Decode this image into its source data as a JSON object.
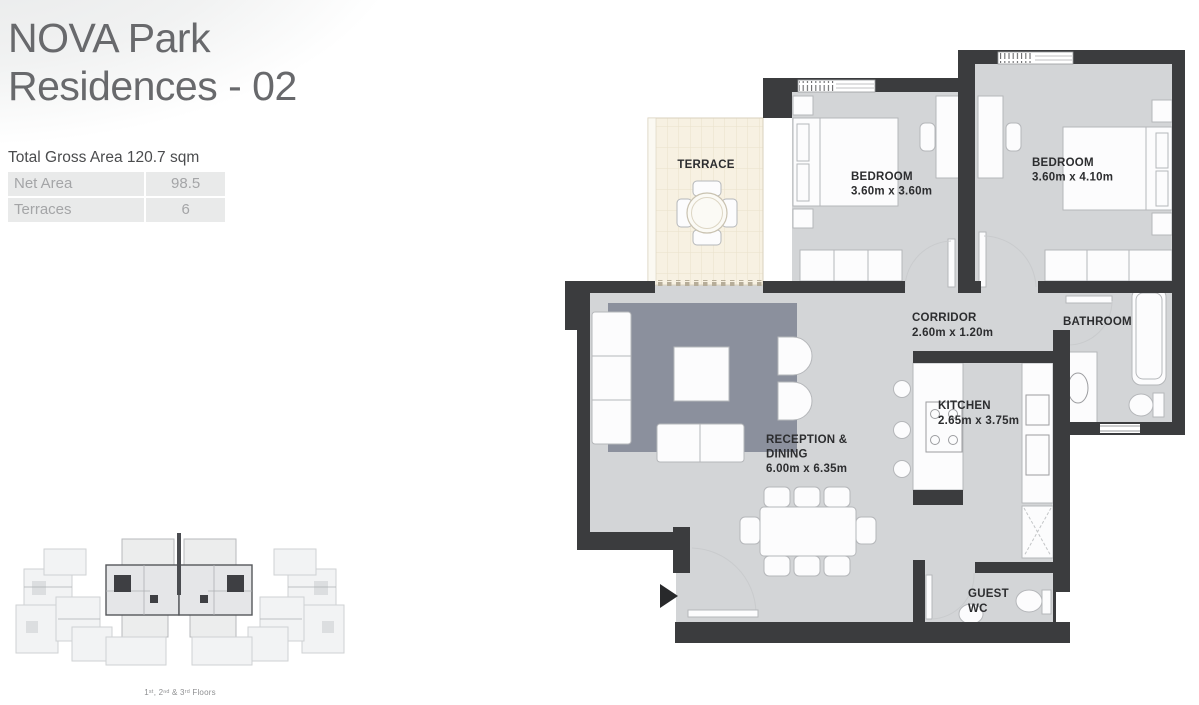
{
  "header": {
    "title_line1": "NOVA Park",
    "title_line2": "Residences - 02",
    "total_area": "Total Gross Area 120.7 sqm"
  },
  "area_table": {
    "rows": [
      {
        "label": "Net Area",
        "value": "98.5"
      },
      {
        "label": "Terraces",
        "value": "6"
      }
    ]
  },
  "key_plan": {
    "caption": "1ˢᵗ, 2ⁿᵈ & 3ʳᵈ Floors"
  },
  "plan": {
    "terrace": {
      "name": "TERRACE"
    },
    "bedroom1": {
      "name": "BEDROOM",
      "dims": "3.60m x 3.60m"
    },
    "bedroom2": {
      "name": "BEDROOM",
      "dims": "3.60m x 4.10m"
    },
    "corridor": {
      "name": "CORRIDOR",
      "dims": "2.60m x 1.20m"
    },
    "bathroom": {
      "name": "BATHROOM"
    },
    "kitchen": {
      "name": "KITCHEN",
      "dims": "2.65m x 3.75m"
    },
    "reception": {
      "name_line1": "RECEPTION &",
      "name_line2": "DINING",
      "dims": "6.00m x 6.35m"
    },
    "guest_wc": {
      "name_line1": "GUEST",
      "name_line2": "WC"
    }
  },
  "colors": {
    "wall": "#3b3c3e",
    "floor": "#d3d5d7",
    "rug": "#8b909d",
    "terrace": "#f7f1e2",
    "terrace-line": "#eae1cb",
    "terrace-tick": "#b6ad99",
    "furniture": "#fcfcfd",
    "furniture-stroke": "#b5b7ba",
    "label": "#2c2d2f",
    "title": "#68696c",
    "table-bg": "#e9eaea",
    "table-text": "#a4a5a7"
  }
}
